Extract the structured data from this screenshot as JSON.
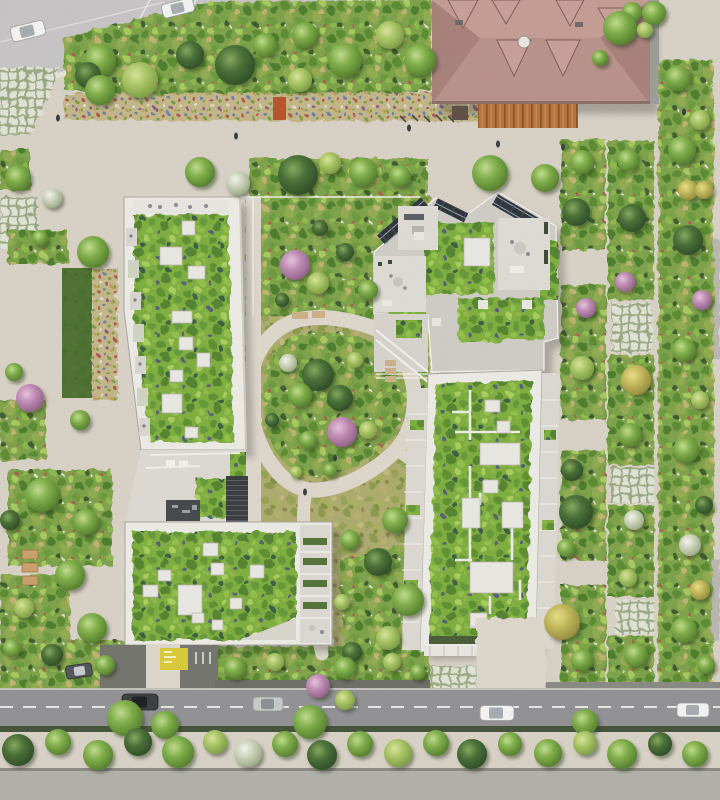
{
  "scene": {
    "type": "aerial-architectural-rendering",
    "description": "Top-down rendering of a residential city block: four green-roof apartment buildings around a landscaped courtyard with a looping footpath, a tan hipped-roof heritage building at top right, tree-lined streets with parked cars and planted promenades.",
    "palette": {
      "plaza": "#d8d1c6",
      "walk": "#ddd6cb",
      "road_north": "#c7c4c6",
      "road_south": "#929295",
      "sidewalk": "#b2b0aa",
      "pavement_dark": "#74756e",
      "roof_white": "#eceae4",
      "green_roof": "#7fae3f",
      "wild": "#7ea34b",
      "meadow": "#adab6e",
      "flower": "#c3b789",
      "lawn": "#3a6526",
      "grid_paver": "#9aa883",
      "concrete": "#cfccc6",
      "terrace": "#dbd8d1",
      "tan_roof": "#b8928b",
      "tan_roof_light": "#c49d94",
      "tan_roof_dark": "#a8817b",
      "deck_wood": "#b5733f",
      "solar": "#2f353c",
      "marking_yellow": "#d9ca3a",
      "car_white": "#f2f3f1",
      "car_dark": "#3d4043",
      "car_silver": "#c7cac9",
      "road_line": "#efefec",
      "railing": "#f2f0ea",
      "courtyard_dark": "#474a4d",
      "hedge_dark": "#4b5d3a"
    },
    "objects": {
      "buildings": [
        {
          "id": "west-residence",
          "roof": "extensive green roof with white skylights",
          "shape": "long north-south slab with balconies"
        },
        {
          "id": "southwest-residence",
          "roof": "green roof with skylights and chamfered corner",
          "shape": "rectangle"
        },
        {
          "id": "northeast-residence",
          "roof": "green roof with concrete terraces and solar panels",
          "shape": "angular chevron"
        },
        {
          "id": "east-residence",
          "roof": "green roof with white maintenance paths and balconies",
          "shape": "long north-south slab"
        },
        {
          "id": "heritage-building",
          "roof": "tan hipped roof with dormers and chimney",
          "shape": "rectangular, top right, with wood deck"
        }
      ],
      "courtyard": {
        "feature": "oval looping footpath around a planted garden with flowering trees and benches"
      },
      "vehicles": [
        {
          "color": "white",
          "location": "north street, parked"
        },
        {
          "color": "white",
          "location": "north street, parked"
        },
        {
          "color": "dark",
          "location": "south street"
        },
        {
          "color": "silver",
          "location": "south street"
        },
        {
          "color": "white",
          "location": "south street east"
        },
        {
          "color": "white",
          "location": "south street far east"
        },
        {
          "color": "dark",
          "location": "south pavement under trees"
        }
      ],
      "streets": {
        "north": "diagonal street with parallel parking",
        "south": "tree-lined street with dashed centre line and sidewalks",
        "east": "planted pedestrian promenade with grass-grid pavers",
        "west": "garden walk with lawn, flower beds and benches"
      },
      "amenities": [
        "wood deck terrace",
        "bicycle racks",
        "benches",
        "grass-grid parking pavers",
        "yellow ground marking",
        "external stairs"
      ]
    }
  }
}
